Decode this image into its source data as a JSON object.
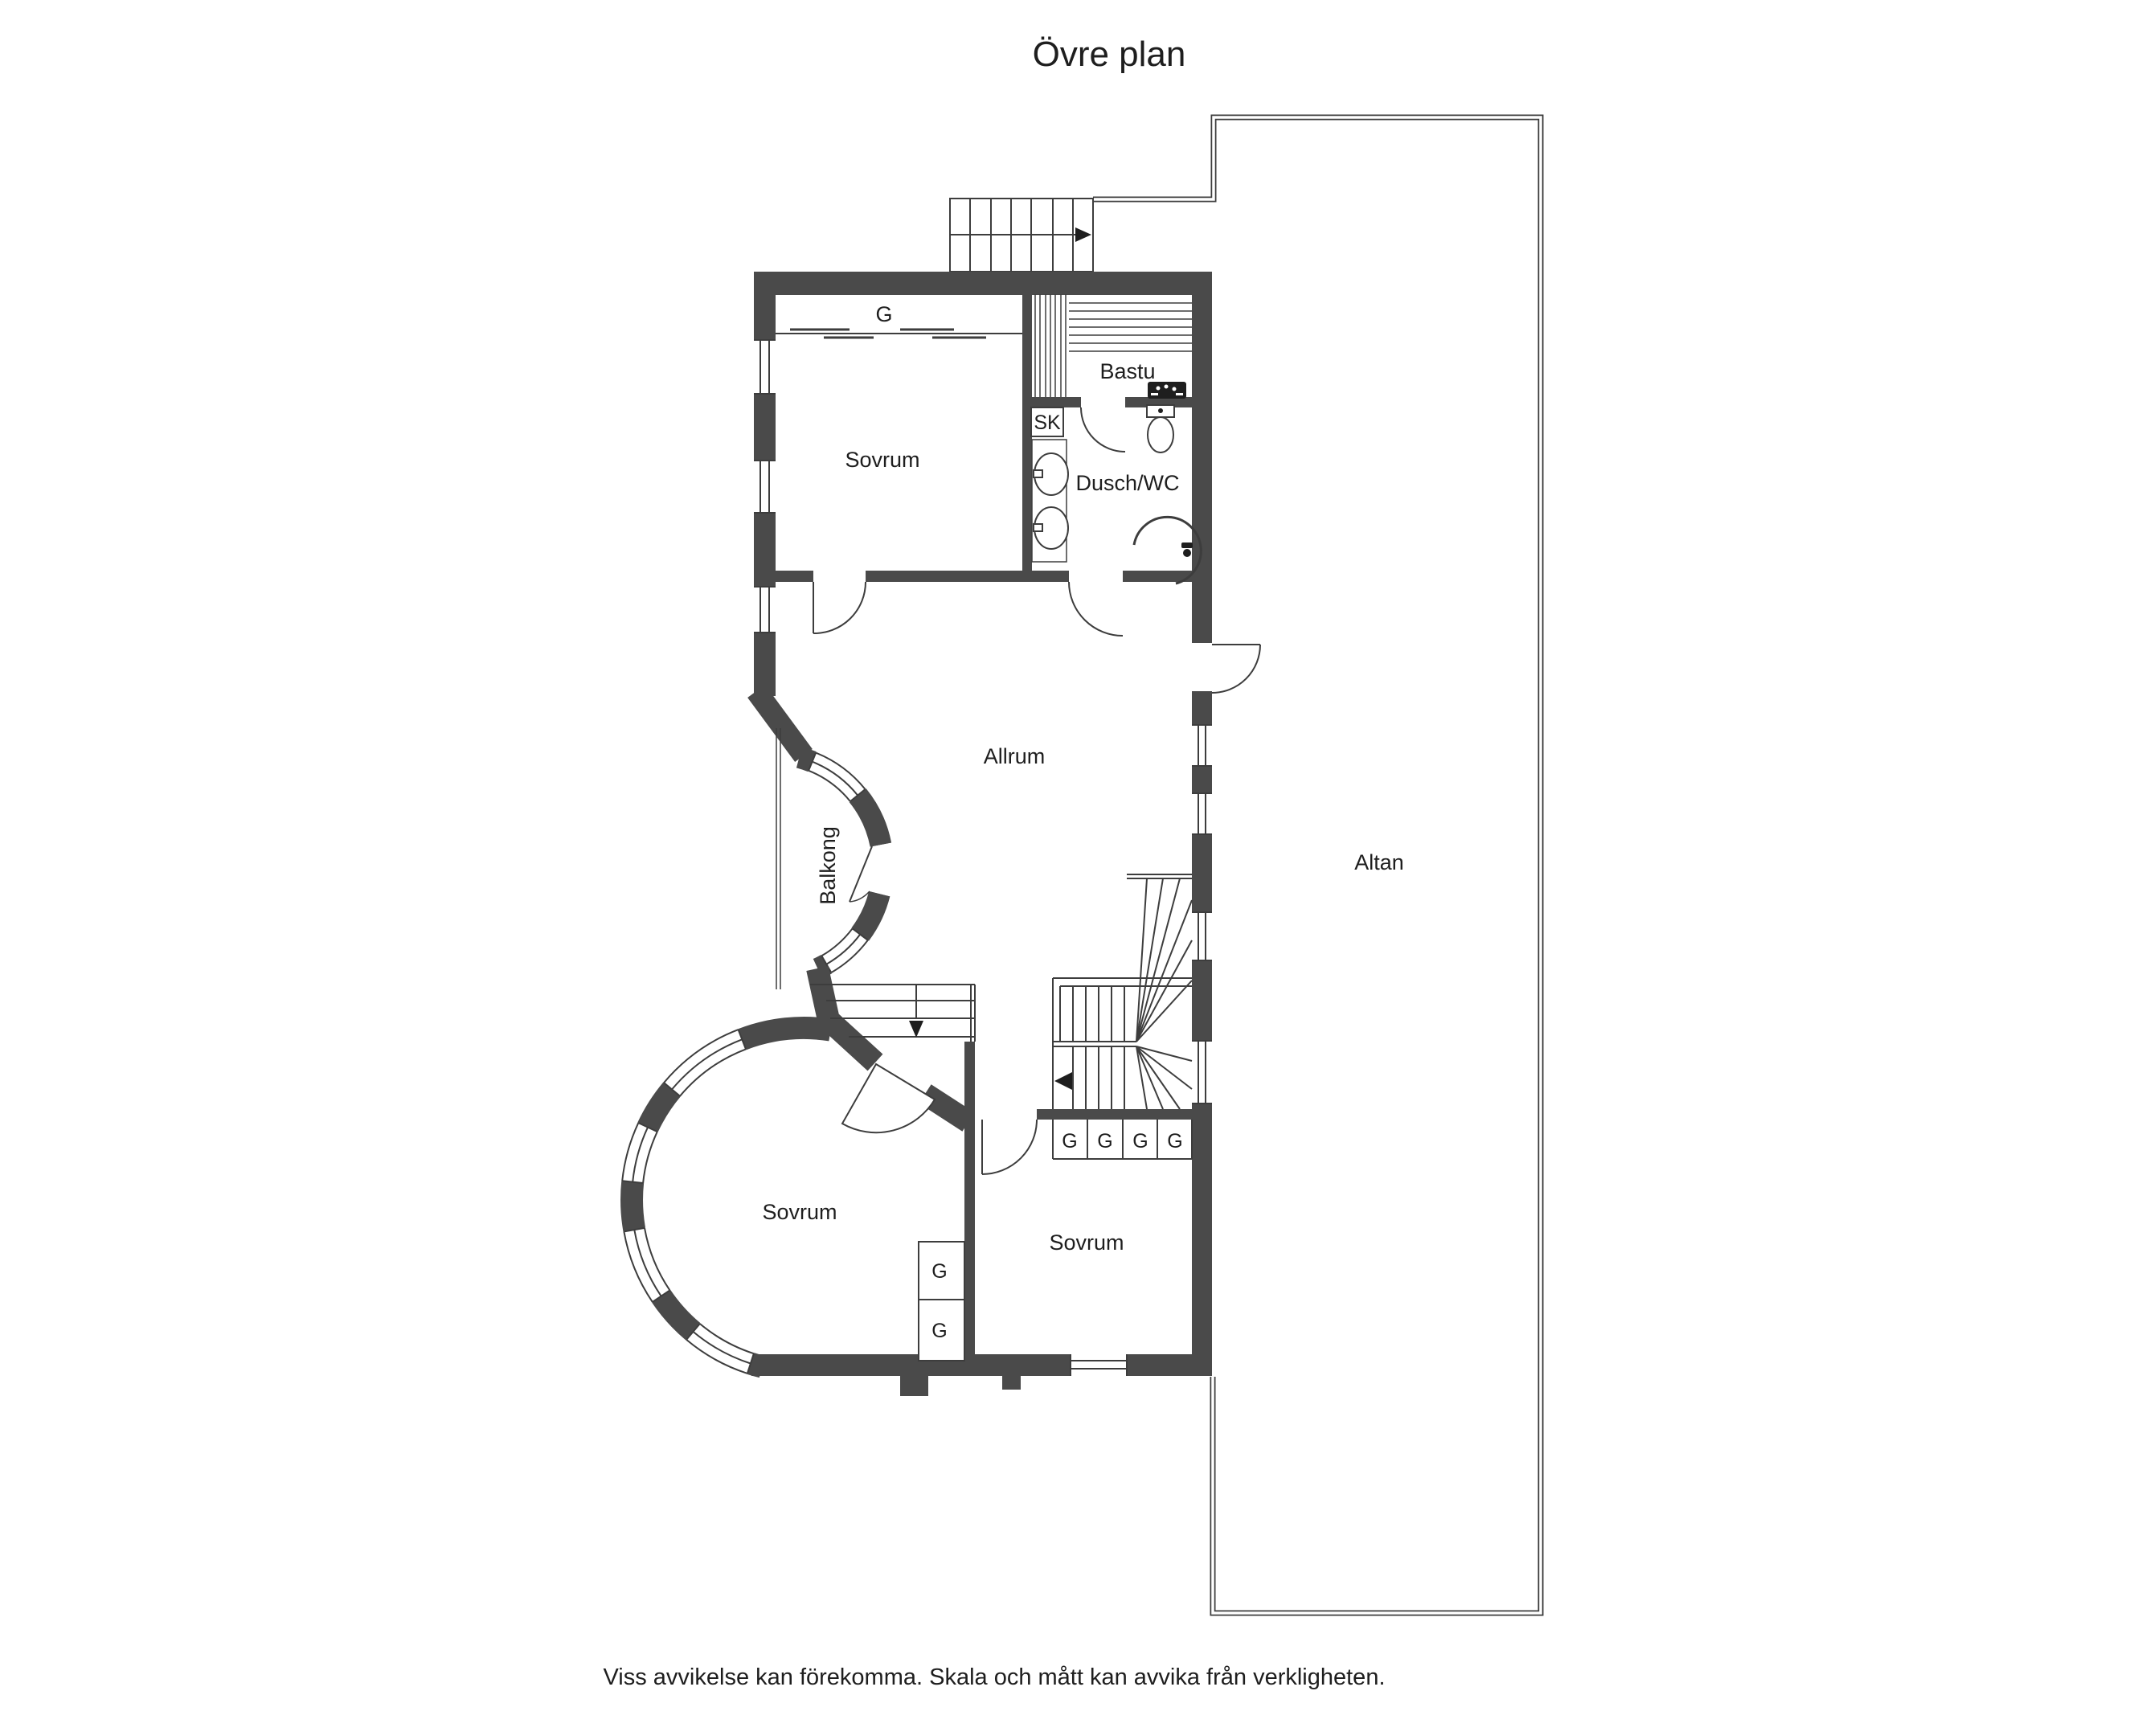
{
  "title": "Övre plan",
  "footer": "Viss avvikelse kan förekomma. Skala och mått kan avvika från verkligheten.",
  "colors": {
    "wall": "#4a4a4a",
    "line": "#3d3d3d",
    "text": "#1e1e1e",
    "background": "#ffffff"
  },
  "labels": {
    "bedroom": "Sovrum",
    "sauna": "Bastu",
    "shower_wc": "Dusch/WC",
    "cleaning_closet": "SK",
    "wardrobe": "G",
    "living_room": "Allrum",
    "balcony": "Balkong",
    "terrace": "Altan"
  }
}
